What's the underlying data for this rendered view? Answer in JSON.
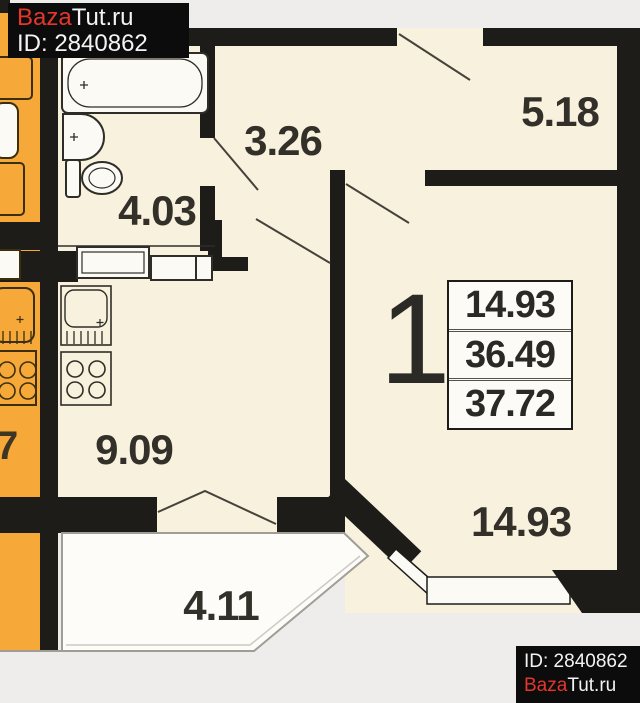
{
  "watermark_top": {
    "brand_red": "Baza",
    "brand_rest": "Tut.ru",
    "id_text": "ID: 2840862"
  },
  "watermark_bottom": {
    "id_text": "ID: 2840862",
    "brand_red": "Baza",
    "brand_rest": "Tut.ru"
  },
  "plan": {
    "apartment_number": "1",
    "info_box": {
      "living_area": "14.93",
      "usable_area": "36.49",
      "total_area": "37.72"
    },
    "room_labels": {
      "hallway": "3.26",
      "entry": "5.18",
      "bathroom": "4.03",
      "kitchen": "9.09",
      "balcony": "4.11",
      "living_room": "14.93"
    },
    "adjacent_apartment_label": "7",
    "fixtures": [
      "bathtub",
      "wash-basin",
      "toilet",
      "kitchen-counter",
      "kitchen-sink",
      "stove",
      "bay-window",
      "balcony-glazing"
    ],
    "colors": {
      "wall": "#1d1c19",
      "interior": "#f7f1dd",
      "adjacent_apartment": "#f6a838",
      "balcony": "#fdfcf8",
      "outside": "#eeedeb",
      "brand_red": "#e5362b"
    }
  }
}
